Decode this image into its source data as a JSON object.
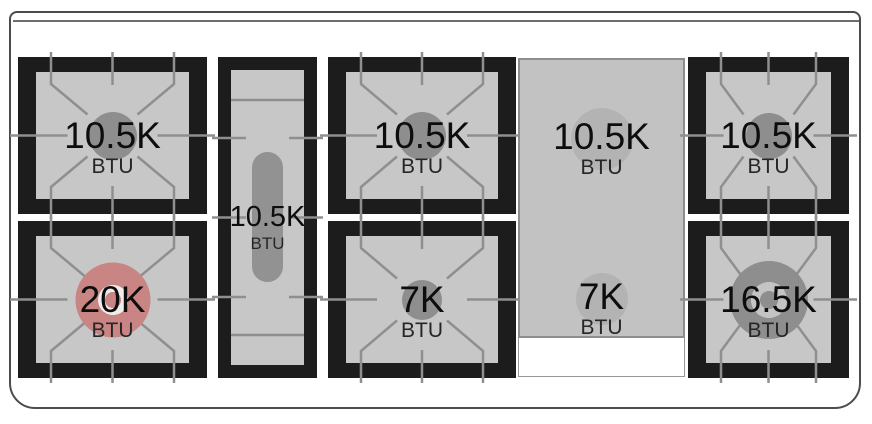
{
  "diagram": {
    "type": "rangetop-burner-layout",
    "rows": 2,
    "burner_count": 8
  },
  "unit": "BTU",
  "burners": [
    {
      "id": "left-rear",
      "power": "10.5K",
      "unit": "BTU",
      "highlighted": false
    },
    {
      "id": "left-front",
      "power": "20K",
      "unit": "BTU",
      "highlighted": true
    },
    {
      "id": "center-oval",
      "power": "10.5K",
      "unit": "BTU",
      "highlighted": false
    },
    {
      "id": "middle-rear",
      "power": "10.5K",
      "unit": "BTU",
      "highlighted": false
    },
    {
      "id": "middle-front",
      "power": "7K",
      "unit": "BTU",
      "highlighted": false
    },
    {
      "id": "griddle-rear",
      "power": "10.5K",
      "unit": "BTU",
      "highlighted": false
    },
    {
      "id": "griddle-front",
      "power": "7K",
      "unit": "BTU",
      "highlighted": false
    },
    {
      "id": "right-rear",
      "power": "10.5K",
      "unit": "BTU",
      "highlighted": false
    },
    {
      "id": "right-front",
      "power": "16.5K",
      "unit": "BTU",
      "highlighted": false
    }
  ],
  "colors": {
    "highlight_red": "#c98484",
    "frame_black": "#1c1c1c",
    "grate_line": "#8f8f8f",
    "surface_gray": "#c7c7c7",
    "griddle_gray": "#c2c2c2",
    "burner_cap_gray": "#8e8e8e"
  }
}
